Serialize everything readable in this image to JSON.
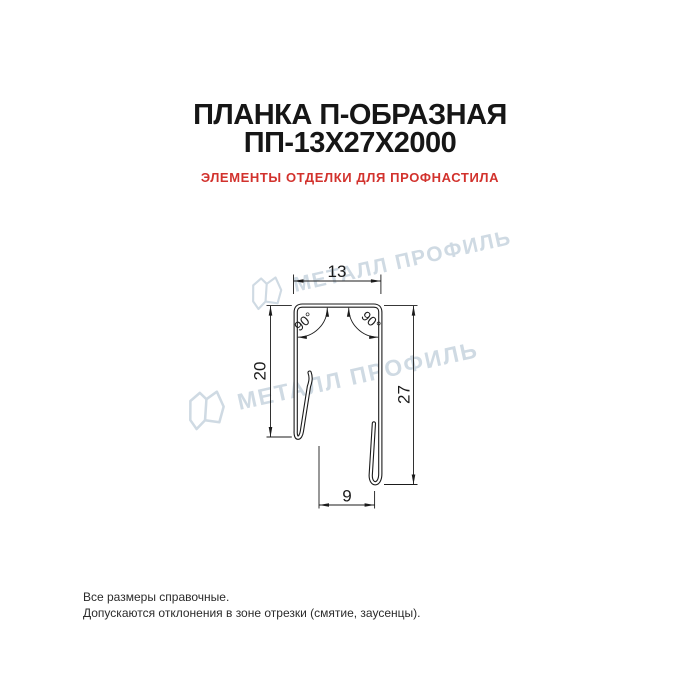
{
  "page": {
    "title_line1": "ПЛАНКА П-ОБРАЗНАЯ",
    "title_line2": "ПП-13Х27Х2000",
    "subtitle": "ЭЛЕМЕНТЫ ОТДЕЛКИ ДЛЯ ПРОФНАСТИЛА"
  },
  "drawing": {
    "dims": {
      "top_width": "13",
      "left_height": "20",
      "right_height": "27",
      "bottom_width": "9",
      "angle_left": "90°",
      "angle_right": "90°"
    }
  },
  "watermarks": {
    "text": "МЕТАЛЛ ПРОФИЛЬ"
  },
  "footer": {
    "line1": "Все размеры справочные.",
    "line2": "Допускаются отклонения в зоне отрезки (смятие, заусенцы)."
  },
  "colors": {
    "title": "#161616",
    "subtitle": "#d2322d",
    "watermark": "#cfdae3",
    "line": "#1b1b1b",
    "background": "#ffffff"
  }
}
